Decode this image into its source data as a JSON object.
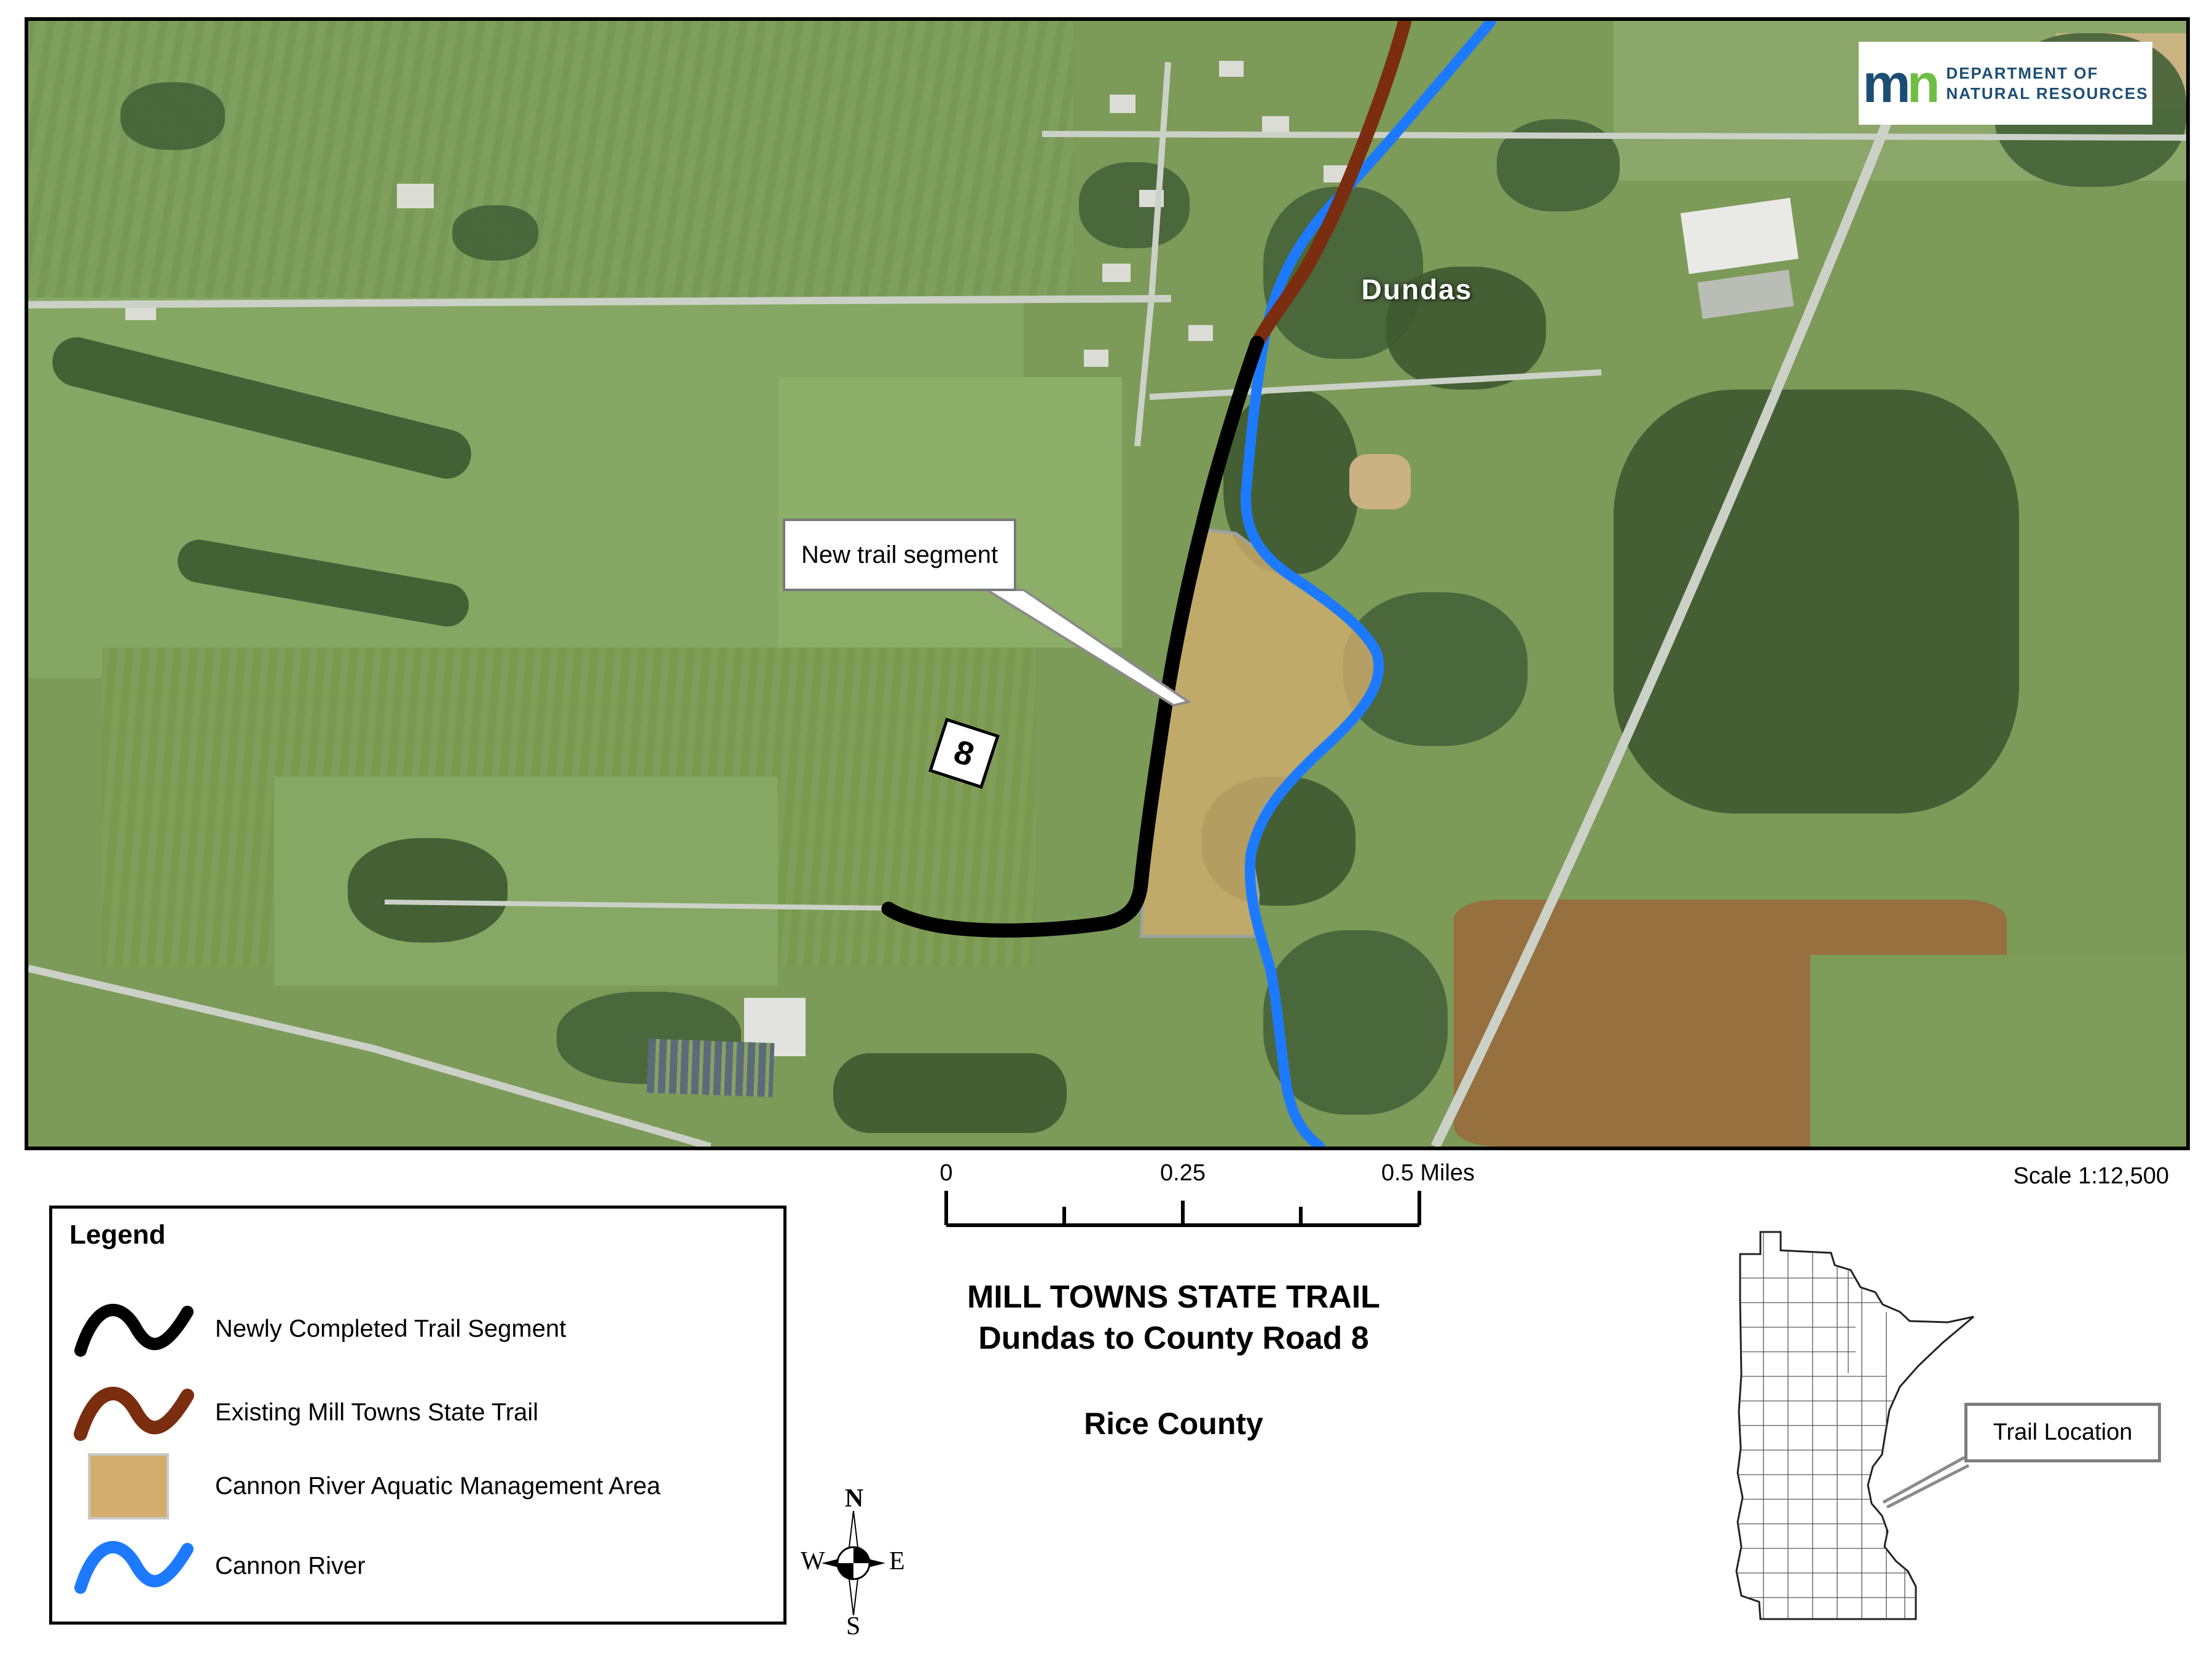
{
  "map": {
    "town_label": "Dundas",
    "callout_label": "New trail segment",
    "road_marker": "8"
  },
  "logo": {
    "mark_m": "m",
    "mark_n": "n",
    "line1": "DEPARTMENT OF",
    "line2": "NATURAL RESOURCES"
  },
  "legend": {
    "title": "Legend",
    "items": [
      {
        "label": "Newly Completed Trail Segment",
        "symbol": "squiggle-line",
        "color": "#000000"
      },
      {
        "label": "Existing Mill Towns State Trail",
        "symbol": "squiggle-line",
        "color": "#7b2d0f"
      },
      {
        "label": "Cannon River Aquatic Management Area",
        "symbol": "area-swatch",
        "color": "#d2ae6e"
      },
      {
        "label": "Cannon River",
        "symbol": "squiggle-line",
        "color": "#1d7aff"
      }
    ]
  },
  "scale_bar": {
    "tick_labels": [
      "0",
      "0.25",
      "0.5 Miles"
    ]
  },
  "titles": {
    "line1": "MILL TOWNS STATE TRAIL",
    "line2": "Dundas to County Road 8",
    "county": "Rice County"
  },
  "compass": {
    "north": "N",
    "south": "S",
    "east": "E",
    "west": "W"
  },
  "scale_note": "Scale 1:12,500",
  "inset": {
    "callout": "Trail Location"
  },
  "colors": {
    "new_trail": "#000000",
    "existing_trail": "#7b2d0f",
    "river": "#1d7aff",
    "ama_fill": "#d2ae6e",
    "ama_border": "#9aa39f",
    "logo_navy": "#1c4e74",
    "logo_green": "#6fbe44"
  }
}
